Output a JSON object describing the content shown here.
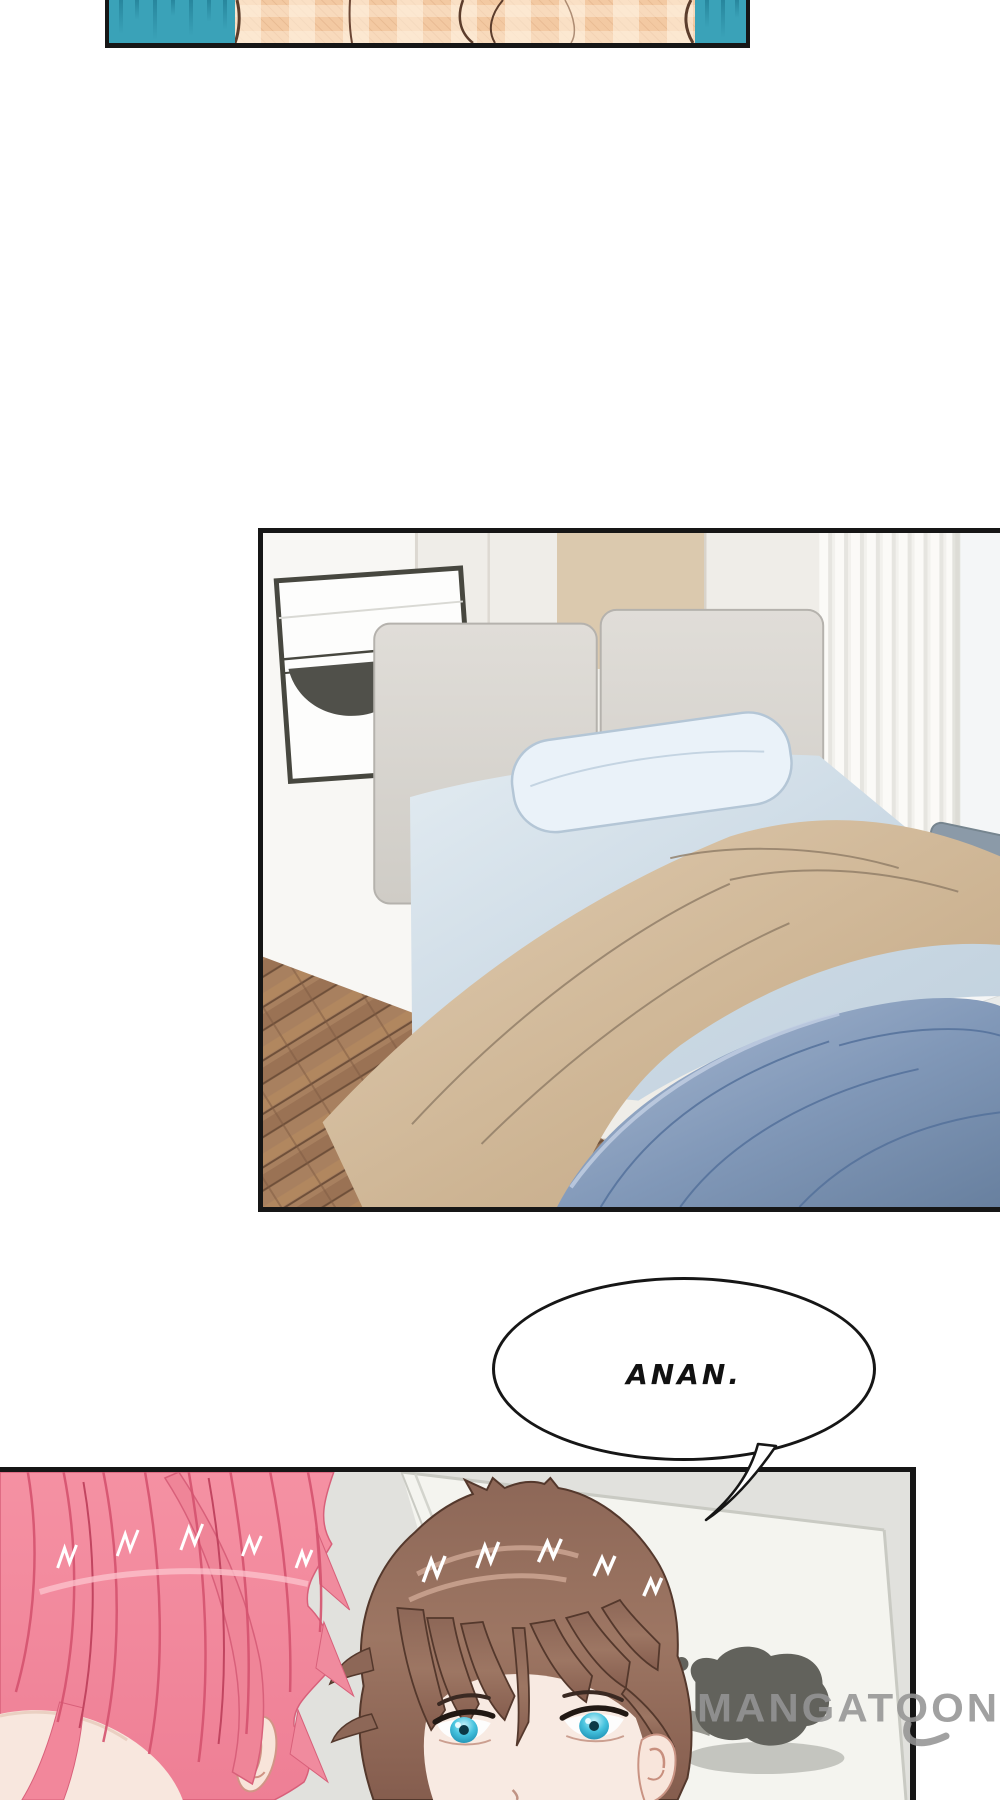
{
  "page": {
    "background": "#ffffff",
    "border_color": "#161616"
  },
  "panels": {
    "intro": {
      "background_teal": "#3aa2b8",
      "streak_color": "#27869d",
      "shirt_color": "#f3c9a2",
      "shirt_outline": "#5c3d2c"
    },
    "bedroom": {
      "wall": "#f2f0ec",
      "accent_wall": "#dbc9ae",
      "headboard": "#d9d6d1",
      "sheet": "#d4e1ec",
      "pillow": "#eaf2f9",
      "tan_blanket": "#cdb698",
      "blue_blanket": "#8198b8",
      "curtain": "#f2f1ed",
      "cushion_stripe": "#7fc8c4",
      "floor": "#a8805f",
      "window_frame": "#47473f"
    },
    "closeup": {
      "wall": "#e4e5e0",
      "board": "#f4f4ef",
      "shadow_blob": "#62625c",
      "girl_hair": "#f18da0",
      "girl_hair_line": "#d5536f",
      "boy_hair": "#97705f",
      "boy_hair_line": "#54382c",
      "boy_eye": "#2fb3d6",
      "skin": "#f8e7de"
    }
  },
  "speech_bubble": {
    "text": "ANAN.",
    "fill": "#ffffff",
    "stroke": "#161616",
    "text_color": "#111111"
  },
  "watermark": {
    "text": "MANGATOON",
    "color": "#959595"
  }
}
